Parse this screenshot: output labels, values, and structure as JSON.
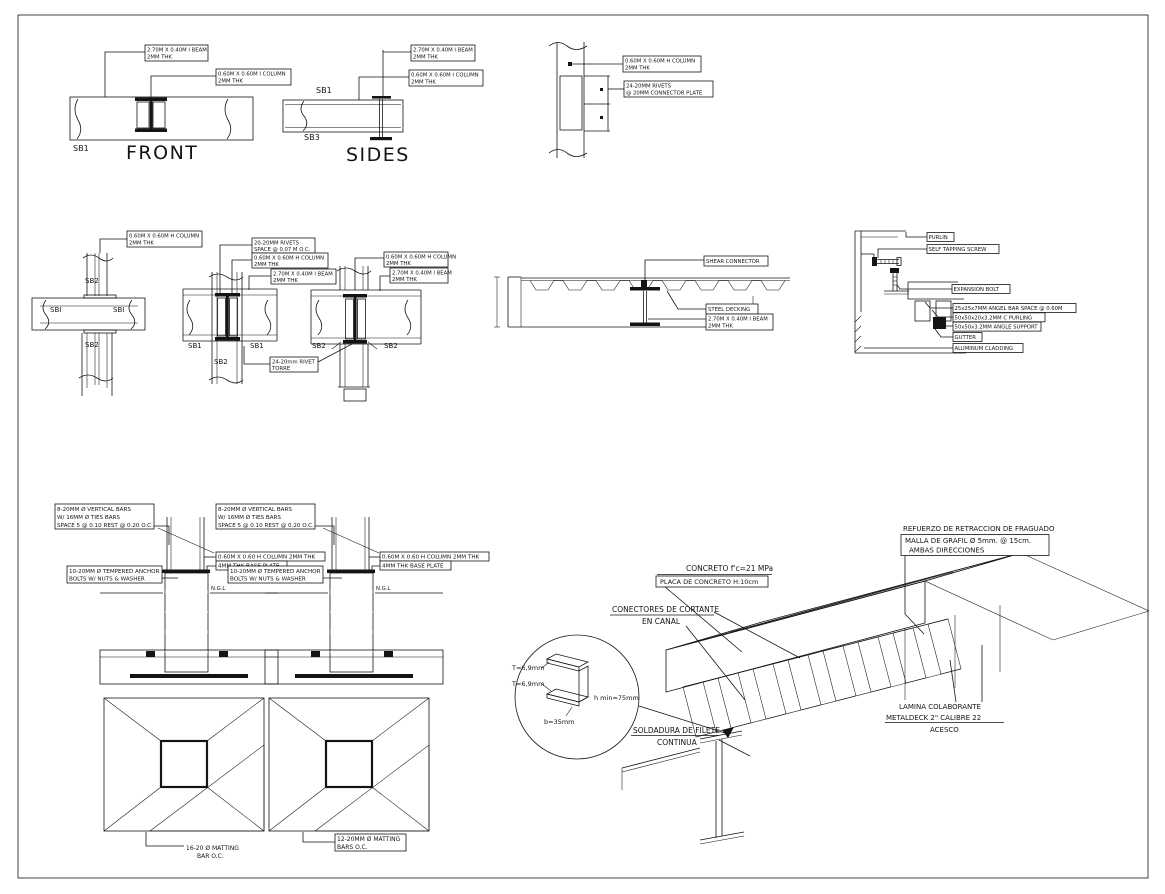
{
  "page": {
    "background": "#ffffff",
    "line_color": "#141414"
  },
  "drawing": {
    "front": {
      "title": "FRONT",
      "tag": "SB1",
      "beam": [
        "2.70M X 0.40M I BEAM",
        "2MM THK"
      ],
      "column": [
        "0.60M X 0.60M I COLUMN",
        "2MM THK"
      ]
    },
    "sides": {
      "title": "SIDES",
      "tag_top": "SB1",
      "tag_bottom": "SB3",
      "beam": [
        "2.70M X 0.40M I BEAM",
        "2MM THK"
      ],
      "column": [
        "0.60M X 0.60M I COLUMN",
        "2MM THK"
      ]
    },
    "splice": {
      "column": [
        "0.60M X 0.60M H COLUMN",
        "2MM THK"
      ],
      "rivets": [
        "24-20MM RIVETS",
        "@ 20MM CONNECTOR PLATE"
      ]
    },
    "cross": {
      "column": [
        "0.60M X 0.60M H COLUMN",
        "2MM THK"
      ],
      "tag_top": "SB2",
      "tag_left": "SBI",
      "tag_right": "SBI",
      "tag_bottom": "SB2"
    },
    "joint_a": {
      "rivets": [
        "20-20MM RIVETS",
        "SPACE @ 0.07 M O.C."
      ],
      "column": [
        "0.60M X 0.60M H COLUMN",
        "2MM THK"
      ],
      "beam": [
        "2.70M X 0.40M I BEAM",
        "2MM THK"
      ],
      "tag_left": "SB1",
      "tag_right": "SB1",
      "tag_bottom": "SB2",
      "note": [
        "24-20mm RIVET",
        "TORRE"
      ]
    },
    "joint_b": {
      "column": [
        "0.60M X 0.60M H COLUMN",
        "2MM THK"
      ],
      "beam": [
        "2.70M X 0.40M I BEAM",
        "2MM THK"
      ],
      "tag_left": "SB2",
      "tag_right": "SB2"
    },
    "deck": {
      "shear": "SHEAR CONNECTOR",
      "decking": "STEEL DECKING",
      "beam": [
        "2.70M X 0.40M I BEAM",
        "2MM THK"
      ]
    },
    "cladding": {
      "labels": [
        "PURLIN",
        "SELF TAPPING SCREW",
        "EXPANSION BOLT",
        "25x25x7MM ANGEL BAR SPACE @ 0.60M",
        "50x50x20x3.2MM C PURLING",
        "50x50x3.2MM ANGLE SUPPORT",
        "GUTTER",
        "ALUMINUM CLADDING"
      ]
    },
    "foundation": {
      "bars": [
        "8-20MM Ø VERTICAL BARS",
        "W/ 16MM Ø TIES BARS",
        "SPACE 5 @ 0.10 REST @ 0.20 O.C."
      ],
      "anchor": [
        "10-20MM Ø TEMPERED ANCHOR",
        "BOLTS W/ NUTS & WASHER"
      ],
      "column": "0.60M X 0.60 H COLUMN 2MM THK",
      "plate": "4MM THK BASE PLATE",
      "ngl": "N.G.L",
      "matting_a": [
        "16-20 Ø MATTING",
        "BAR O.C."
      ],
      "matting_b": [
        "12-20MM Ø MATTING",
        "BARS O.C."
      ]
    },
    "iso": {
      "concreto": "CONCRETO f'c=21 MPa",
      "placa": "PLACA DE CONCRETO H:10cm",
      "conectores": [
        "CONECTORES DE CORTANTE",
        "EN CANAL"
      ],
      "refuerzo": "REFUERZO DE RETRACCION DE FRAGUADO",
      "malla": [
        "MALLA DE GRAFIL Ø 5mm. @ 15cm.",
        "AMBAS DIRECCIONES"
      ],
      "lamina": [
        "LAMINA COLABORANTE",
        "METALDECK 2\" CALIBRE 22",
        "ACESCO"
      ],
      "soldadura": [
        "SOLDADURA DE FILETE",
        "CONTINUA"
      ],
      "dims": {
        "t1": "T=6,9mm",
        "t2": "T=6,9mm",
        "h": "h min=75mm",
        "b": "b=35mm"
      }
    }
  }
}
